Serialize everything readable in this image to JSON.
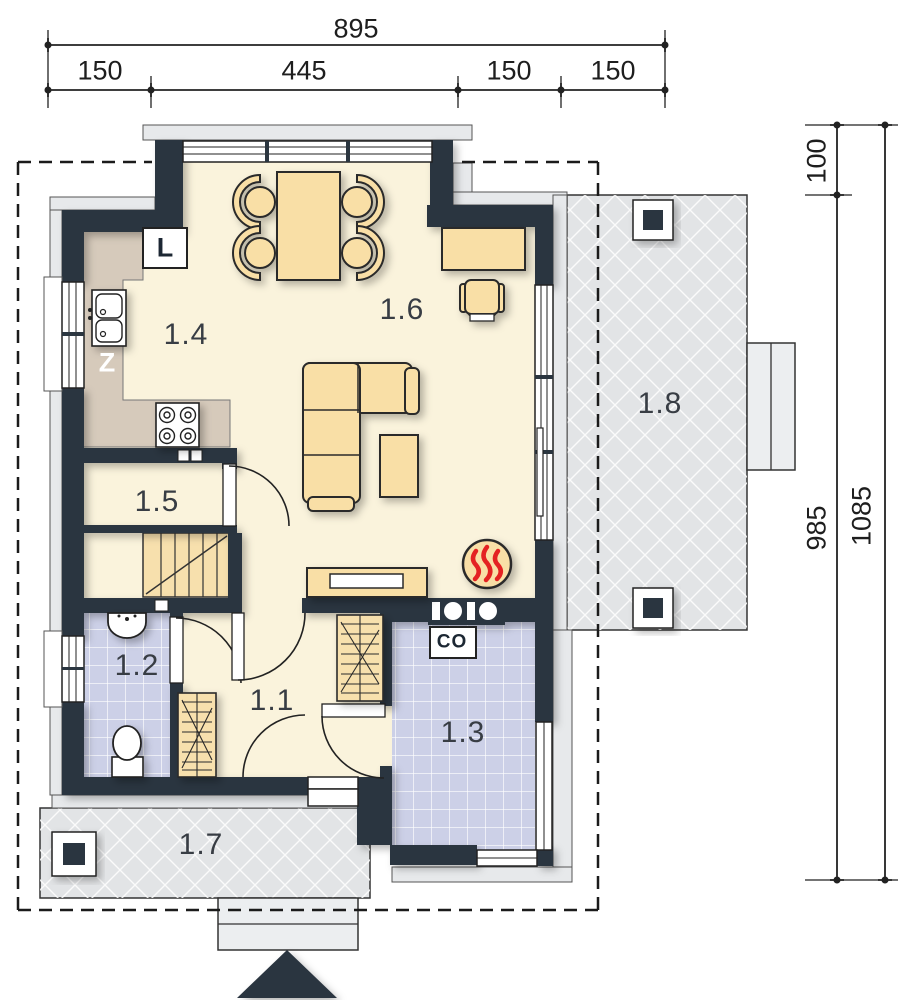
{
  "plan": {
    "title": "ground floor plan",
    "rooms": [
      {
        "label": "1.1"
      },
      {
        "label": "1.2"
      },
      {
        "label": "1.3"
      },
      {
        "label": "1.4"
      },
      {
        "label": "1.5"
      },
      {
        "label": "1.6"
      },
      {
        "label": "1.7"
      },
      {
        "label": "1.8"
      }
    ],
    "equipment": {
      "fridge": "L",
      "sink_unit": "Z",
      "central_heating": "CO"
    },
    "dimensions": {
      "top_total": "895",
      "top_segments": [
        "150",
        "445",
        "150",
        "150"
      ],
      "right_offset": "100",
      "right_inner": "985",
      "right_total": "1085"
    },
    "colors": {
      "wall": "#2b3640",
      "floor": "#faf3dc",
      "tile": "#ccd0e7",
      "furniture": "#f9dfa6",
      "counter": "#d6cabb",
      "paving": "#e2e4e6",
      "flame": "#e42320"
    }
  }
}
